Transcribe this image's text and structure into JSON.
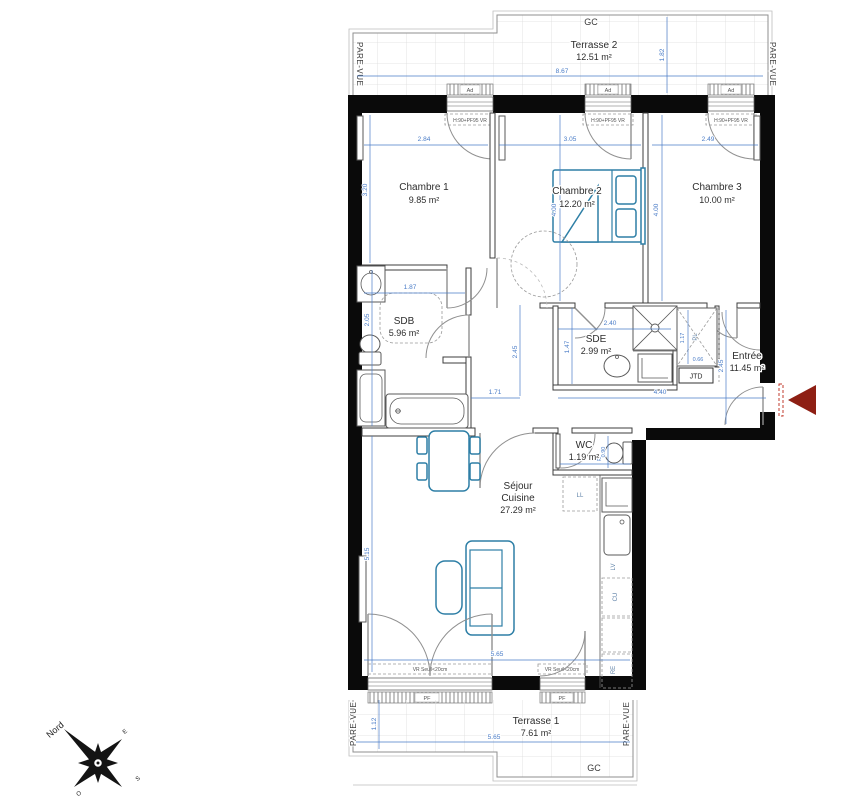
{
  "rooms": {
    "ch1": {
      "name": "Chambre 1",
      "area": "9.85 m²"
    },
    "ch2": {
      "name": "Chambre 2",
      "area": "12.20 m²"
    },
    "ch3": {
      "name": "Chambre 3",
      "area": "10.00 m²"
    },
    "sdb": {
      "name": "SDB",
      "area": "5.96 m²"
    },
    "sde": {
      "name": "SDE",
      "area": "2.99 m²"
    },
    "entree": {
      "name": "Entrée",
      "area": "11.45 m²"
    },
    "wc": {
      "name": "WC",
      "area": "1.19 m²"
    },
    "sejour": {
      "line1": "Séjour",
      "line2": "Cuisine",
      "area": "27.29 m²"
    },
    "terrasse1": {
      "name": "Terrasse 1",
      "area": "7.61 m²"
    },
    "terrasse2": {
      "name": "Terrasse 2",
      "area": "12.51 m²"
    }
  },
  "dims": {
    "t2_w": "8.67",
    "t2_d": "1.82",
    "ch1_w": "2.84",
    "ch1_h": "3.20",
    "ch2_w": "3.05",
    "ch2_h": "4.00",
    "ch3_w": "2.49",
    "ch3_h": "4.00",
    "sdb_w": "1.87",
    "sdb_h": "2.05",
    "sde_w": "2.40",
    "sde_h": "1.47",
    "hall_h": "2.45",
    "hall_w": "1.71",
    "ent_h": "2.45",
    "ent_w": "4.40",
    "wc_h": "0.90",
    "wc_w": "1.32",
    "pl_h": "1.17",
    "pl_w": "0.66",
    "sej_h": "5.15",
    "sej_w": "5.65",
    "t1_w": "5.65",
    "t1_d": "1.12"
  },
  "annot": {
    "gc": "GC",
    "pare_vue": "PARE-VUE",
    "pf": "PF",
    "ad": "Ad",
    "vr_note": "VR Seuil<20cm",
    "win_note": "H:90+PF95 VR",
    "jtd": "JTD",
    "pl": "PL",
    "ll": "LL",
    "lv": "LV",
    "cu": "CU",
    "re": "RE"
  },
  "compass": {
    "north": "Nord",
    "e": "E",
    "s": "S",
    "o": "O"
  },
  "colors": {
    "wall": "#0a0a0a",
    "dimension_blue": "#4a7cc7",
    "furniture_teal": "#2e7fa6",
    "entry_arrow_red": "#8e1f14",
    "tile_grey": "#dcdcdc"
  }
}
